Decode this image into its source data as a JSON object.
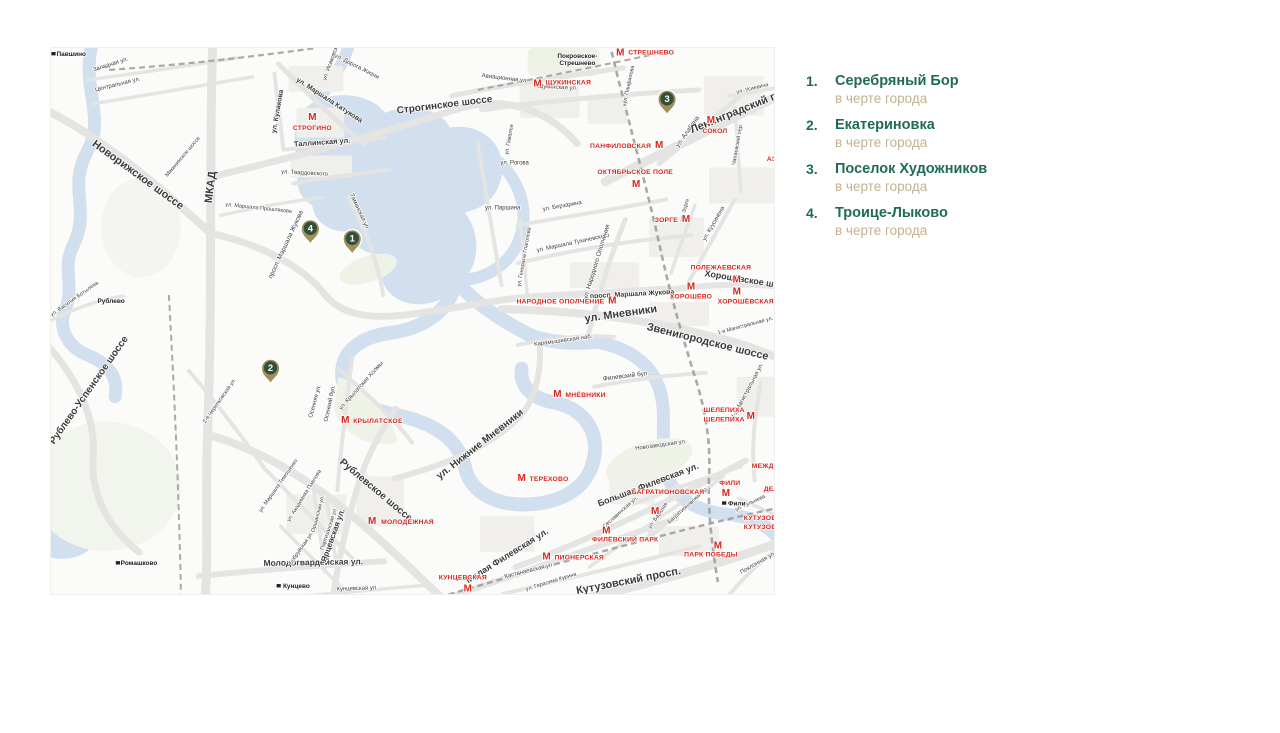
{
  "legend": {
    "items": [
      {
        "number": "1.",
        "name": "Серебряный Бор",
        "note": "в черте города"
      },
      {
        "number": "2.",
        "name": "Екатериновка",
        "note": "в черте города"
      },
      {
        "number": "3.",
        "name": "Поселок Художников",
        "note": "в черте города"
      },
      {
        "number": "4.",
        "name": "Троице-Лыково",
        "note": "в черте города"
      }
    ]
  },
  "map": {
    "metro_symbol": "М",
    "colors": {
      "legend_green": "#1f6b58",
      "legend_tan": "#c3b290",
      "metro_red": "#d7261e",
      "water": "#d2dfee",
      "road": "#e4e4e2",
      "rail": "#9a9a9a",
      "pin_fill": "#a28e58",
      "pin_circle": "#30503a"
    },
    "pins": [
      {
        "n": "1",
        "x": 302,
        "y": 191
      },
      {
        "n": "2",
        "x": 220,
        "y": 321
      },
      {
        "n": "3",
        "x": 618,
        "y": 51
      },
      {
        "n": "4",
        "x": 260,
        "y": 181
      }
    ],
    "metro_stations": [
      {
        "lines": [
          "СТРЕШНЕВО"
        ],
        "mx": 571,
        "my": 4,
        "lx": 579,
        "ly": 4,
        "a": "start"
      },
      {
        "lines": [
          "ЩУКИНСКАЯ"
        ],
        "mx": 488,
        "my": 35,
        "lx": 496,
        "ly": 34,
        "a": "start"
      },
      {
        "lines": [
          "СТРОГИНО"
        ],
        "mx": 262,
        "my": 69,
        "lx": 262,
        "ly": 80,
        "a": "middle"
      },
      {
        "lines": [
          "ПАНФИЛОВСКАЯ"
        ],
        "mx": 610,
        "my": 97,
        "lx": 602,
        "ly": 98,
        "a": "end"
      },
      {
        "lines": [
          "ОКТЯБРЬСКОЕ ПОЛЕ"
        ],
        "mx": 587,
        "my": 136,
        "lx": 586,
        "ly": 124,
        "a": "middle"
      },
      {
        "lines": [
          "СОКОЛ"
        ],
        "mx": 662,
        "my": 72,
        "lx": 666,
        "ly": 83,
        "a": "middle"
      },
      {
        "lines": [
          "ЗОРГЕ"
        ],
        "mx": 637,
        "my": 171,
        "lx": 629,
        "ly": 172,
        "a": "end"
      },
      {
        "lines": [
          "ПОЛЕЖАЕВСКАЯ"
        ],
        "mx": 688,
        "my": 232,
        "lx": 672,
        "ly": 220,
        "a": "middle"
      },
      {
        "lines": [
          "ХОРОШЁВСКАЯ"
        ],
        "mx": 688,
        "my": 244,
        "lx": 697,
        "ly": 254,
        "a": "middle"
      },
      {
        "lines": [
          "ХОРОШЁВО"
        ],
        "mx": 642,
        "my": 239,
        "lx": 642,
        "ly": 249,
        "a": "middle"
      },
      {
        "lines": [
          "НАРОДНОЕ ОПОЛЧЕНИЕ"
        ],
        "mx": 563,
        "my": 253,
        "lx": 555,
        "ly": 254,
        "a": "end"
      },
      {
        "lines": [
          "МНЁВНИКИ"
        ],
        "mx": 508,
        "my": 347,
        "lx": 516,
        "ly": 348,
        "a": "start"
      },
      {
        "lines": [
          "ТЕРЕХОВО"
        ],
        "mx": 472,
        "my": 431,
        "lx": 480,
        "ly": 432,
        "a": "start"
      },
      {
        "lines": [
          "КРЫЛАТСКОЕ"
        ],
        "mx": 295,
        "my": 373,
        "lx": 303,
        "ly": 374,
        "a": "start"
      },
      {
        "lines": [
          "МОЛОДЁЖНАЯ"
        ],
        "mx": 322,
        "my": 474,
        "lx": 331,
        "ly": 475,
        "a": "start"
      },
      {
        "lines": [
          "КУНЦЕВСКАЯ"
        ],
        "mx": 418,
        "my": 542,
        "lx": 413,
        "ly": 531,
        "a": "middle"
      },
      {
        "lines": [
          "ПИОНЕРСКАЯ"
        ],
        "mx": 497,
        "my": 510,
        "lx": 505,
        "ly": 511,
        "a": "start"
      },
      {
        "lines": [
          "ФИЛЁВСКИЙ ПАРК"
        ],
        "mx": 557,
        "my": 484,
        "lx": 576,
        "ly": 493,
        "a": "middle"
      },
      {
        "lines": [
          "БАГРАТИОНОВСКАЯ"
        ],
        "mx": 606,
        "my": 464,
        "lx": 619,
        "ly": 445,
        "a": "middle"
      },
      {
        "lines": [
          "ФИЛИ"
        ],
        "mx": 677,
        "my": 446,
        "lx": 681,
        "ly": 436,
        "a": "middle"
      },
      {
        "lines": [
          "ПАРК ПОБЕДЫ"
        ],
        "mx": 669,
        "my": 499,
        "lx": 662,
        "ly": 508,
        "a": "middle"
      },
      {
        "lines": [
          "ШЕЛЕПИХА",
          "ШЕЛЕПИХА"
        ],
        "mx": 702,
        "my": 369,
        "lx": 696,
        "ly": 363,
        "a": "end"
      },
      {
        "lines": [
          "МЕЖДУНАРОДНАЯ"
        ],
        "mx": 782,
        "my": 418,
        "lx": 703,
        "ly": 419,
        "a": "start"
      },
      {
        "lines": [
          "ДЕЛОВОЙ ЦЕНТР"
        ],
        "mx": 784,
        "my": 441,
        "lx": 715,
        "ly": 442,
        "a": "start"
      },
      {
        "lines": [
          "КУТУЗОВСКАЯ",
          "КУТУЗОВСКАЯ"
        ],
        "mx": 782,
        "my": 479,
        "lx": 695,
        "ly": 471,
        "a": "start"
      },
      {
        "lines": [
          "АЭРОПОРТ"
        ],
        "mx": 782,
        "my": 110,
        "lx": 718,
        "ly": 111,
        "a": "start"
      }
    ],
    "rail_stations": [
      {
        "lines": [
          "Павшино"
        ],
        "x": 20,
        "y": 8,
        "ic": true
      },
      {
        "lines": [
          "Покровское-",
          "Стрешнево"
        ],
        "x": 528,
        "y": 10,
        "ic": false
      },
      {
        "lines": [
          "Кунцево"
        ],
        "x": 246,
        "y": 542,
        "ic": true
      },
      {
        "lines": [
          "Фили"
        ],
        "x": 688,
        "y": 459,
        "ic": true
      },
      {
        "lines": [
          "Ромашково"
        ],
        "x": 88,
        "y": 519,
        "ic": true
      },
      {
        "lines": [
          "Рублево"
        ],
        "x": 60,
        "y": 256,
        "ic": false
      }
    ],
    "street_labels": [
      {
        "t": "Западная ул.",
        "x": 60,
        "y": 18,
        "r": -18,
        "s": 6
      },
      {
        "t": "Центральная ул.",
        "x": 67,
        "y": 38,
        "r": -14,
        "s": 6
      },
      {
        "t": "Новорижское шоссе",
        "x": 85,
        "y": 130,
        "r": 36,
        "s": 11,
        "w": 1
      },
      {
        "t": "МКАД",
        "x": 163,
        "y": 140,
        "r": -83,
        "s": 11,
        "w": 1
      },
      {
        "t": "ул. Маршала Прошлякова",
        "x": 208,
        "y": 162,
        "r": 6,
        "s": 5.5
      },
      {
        "t": "просп. Маршала Жукова",
        "x": 237,
        "y": 198,
        "r": -65,
        "s": 6.5
      },
      {
        "t": "ул. Маршала Катукова",
        "x": 278,
        "y": 54,
        "r": 33,
        "s": 7,
        "w": 1
      },
      {
        "t": "ул. Дорога Жизни",
        "x": 306,
        "y": 20,
        "r": 27,
        "s": 6
      },
      {
        "t": "Строгинское шоссе",
        "x": 395,
        "y": 60,
        "r": -7,
        "s": 10,
        "w": 1
      },
      {
        "t": "Авиационная ул.",
        "x": 455,
        "y": 32,
        "r": 7,
        "s": 6
      },
      {
        "t": "ул. Кулакова",
        "x": 229,
        "y": 64,
        "r": -80,
        "s": 7,
        "w": 1
      },
      {
        "t": "Таллинская ул.",
        "x": 272,
        "y": 97,
        "r": -4,
        "s": 7.5,
        "w": 1
      },
      {
        "t": "ул. Твардовского",
        "x": 254,
        "y": 127,
        "r": 3,
        "s": 6
      },
      {
        "t": "ул. Исаковского",
        "x": 283,
        "y": 12,
        "r": -70,
        "s": 6
      },
      {
        "t": "ул. Рогова",
        "x": 465,
        "y": 117,
        "r": 0,
        "s": 6
      },
      {
        "t": "ул. Паршина",
        "x": 453,
        "y": 162,
        "r": 0,
        "s": 6
      },
      {
        "t": "ул. Гамалеи",
        "x": 461,
        "y": 92,
        "r": -80,
        "s": 5.5
      },
      {
        "t": "ул. Берзарина",
        "x": 513,
        "y": 160,
        "r": -10,
        "s": 6
      },
      {
        "t": "Таманская ул.",
        "x": 308,
        "y": 165,
        "r": 65,
        "s": 6
      },
      {
        "t": "ул. Маршала Тухачевского",
        "x": 524,
        "y": 197,
        "r": -12,
        "s": 6
      },
      {
        "t": "ул. Народного Ополчения",
        "x": 549,
        "y": 215,
        "r": -73,
        "s": 6.5
      },
      {
        "t": "ул. Генерала Глаголева",
        "x": 476,
        "y": 210,
        "r": -80,
        "s": 5.5
      },
      {
        "t": "просп. Маршала Жукова",
        "x": 583,
        "y": 249,
        "r": -3,
        "s": 7,
        "w": 1
      },
      {
        "t": "ул. Мневники",
        "x": 572,
        "y": 270,
        "r": -8,
        "s": 11,
        "w": 1
      },
      {
        "t": "Звенигородское шоссе",
        "x": 658,
        "y": 298,
        "r": 14,
        "s": 11,
        "w": 1
      },
      {
        "t": "Хорошёвское шоссе",
        "x": 700,
        "y": 236,
        "r": 9,
        "s": 9,
        "w": 1
      },
      {
        "t": "ул. Куусинена",
        "x": 666,
        "y": 177,
        "r": -60,
        "s": 6
      },
      {
        "t": "ул. Зорге",
        "x": 637,
        "y": 163,
        "r": -75,
        "s": 5.5
      },
      {
        "t": "ул. Алабяна",
        "x": 640,
        "y": 85,
        "r": -55,
        "s": 6.5
      },
      {
        "t": "Ленинградский проспект",
        "x": 706,
        "y": 60,
        "r": -22,
        "s": 11,
        "w": 1
      },
      {
        "t": "Чапаевский пер.",
        "x": 690,
        "y": 97,
        "r": -80,
        "s": 5.5
      },
      {
        "t": "ул. Усиевича",
        "x": 704,
        "y": 42,
        "r": -14,
        "s": 5.5
      },
      {
        "t": "Щукинская ул.",
        "x": 508,
        "y": 41,
        "r": 3,
        "s": 6
      },
      {
        "t": "ул. Панфилова",
        "x": 581,
        "y": 37,
        "r": -78,
        "s": 5.5
      },
      {
        "t": "Карамышевская наб.",
        "x": 514,
        "y": 295,
        "r": -8,
        "s": 6
      },
      {
        "t": "Филевский бул.",
        "x": 577,
        "y": 331,
        "r": -7,
        "s": 6.5
      },
      {
        "t": "Новозаводская ул.",
        "x": 612,
        "y": 400,
        "r": -8,
        "s": 6
      },
      {
        "t": "ул. Нижние Мневники",
        "x": 432,
        "y": 400,
        "r": -38,
        "s": 10,
        "w": 1
      },
      {
        "t": "Большая Филевская ул.",
        "x": 600,
        "y": 441,
        "r": -21,
        "s": 9,
        "w": 1
      },
      {
        "t": "Багратионовский пр.",
        "x": 640,
        "y": 460,
        "r": -42,
        "s": 5.5
      },
      {
        "t": "Сеславинская ул.",
        "x": 572,
        "y": 467,
        "r": -42,
        "s": 5.5
      },
      {
        "t": "ул. Барклая",
        "x": 610,
        "y": 470,
        "r": -55,
        "s": 5.5
      },
      {
        "t": "Малая Филевская ул.",
        "x": 459,
        "y": 512,
        "r": -32,
        "s": 9,
        "w": 1
      },
      {
        "t": "Кастанаевская ул.",
        "x": 480,
        "y": 526,
        "r": -14,
        "s": 6
      },
      {
        "t": "ул. Герасима Курина",
        "x": 502,
        "y": 537,
        "r": -17,
        "s": 5.5
      },
      {
        "t": "Кутузовский просп.",
        "x": 580,
        "y": 538,
        "r": -11,
        "s": 11,
        "w": 1
      },
      {
        "t": "Поклонная ул.",
        "x": 710,
        "y": 518,
        "r": -30,
        "s": 6
      },
      {
        "t": "ул. Кульнева",
        "x": 702,
        "y": 458,
        "r": -25,
        "s": 5.5
      },
      {
        "t": "Молодогвардейская ул.",
        "x": 263,
        "y": 519,
        "r": -1,
        "s": 8.5,
        "w": 1
      },
      {
        "t": "Кунцевская ул.",
        "x": 307,
        "y": 544,
        "r": -2,
        "s": 6
      },
      {
        "t": "Рублевское шоссе",
        "x": 324,
        "y": 446,
        "r": 40,
        "s": 10,
        "w": 1
      },
      {
        "t": "Ярцевская ул.",
        "x": 285,
        "y": 490,
        "r": -70,
        "s": 8,
        "w": 1
      },
      {
        "t": "ул. Маршала Тимошенко",
        "x": 229,
        "y": 440,
        "r": -55,
        "s": 5.5
      },
      {
        "t": "ул. Академика Павлова",
        "x": 255,
        "y": 450,
        "r": -58,
        "s": 5.5
      },
      {
        "t": "Оршанская ул.",
        "x": 269,
        "y": 468,
        "r": -75,
        "s": 5.5
      },
      {
        "t": "Партизанская ул.",
        "x": 280,
        "y": 483,
        "r": -72,
        "s": 5.5
      },
      {
        "t": "Бобруйская ул.",
        "x": 252,
        "y": 503,
        "r": -55,
        "s": 5.5
      },
      {
        "t": "Осенняя ул.",
        "x": 266,
        "y": 355,
        "r": -75,
        "s": 6
      },
      {
        "t": "Осенний бул.",
        "x": 281,
        "y": 357,
        "r": -78,
        "s": 6
      },
      {
        "t": "ул. Крылатские Холмы",
        "x": 312,
        "y": 340,
        "r": -48,
        "s": 6
      },
      {
        "t": "2-я Черепковская ул.",
        "x": 170,
        "y": 355,
        "r": -55,
        "s": 5.5
      },
      {
        "t": "Рублево-Успенское шоссе",
        "x": 40,
        "y": 345,
        "r": -55,
        "s": 10,
        "w": 1
      },
      {
        "t": "ул. Василия Ботылева",
        "x": 24,
        "y": 253,
        "r": -35,
        "s": 5.5
      },
      {
        "t": "Мякининское шоссе",
        "x": 133,
        "y": 110,
        "r": -50,
        "s": 5.5
      },
      {
        "t": "3-я Магистральная ул.",
        "x": 700,
        "y": 345,
        "r": -62,
        "s": 6
      },
      {
        "t": "1-я Магистральная ул.",
        "x": 697,
        "y": 280,
        "r": -15,
        "s": 5.5
      }
    ]
  }
}
